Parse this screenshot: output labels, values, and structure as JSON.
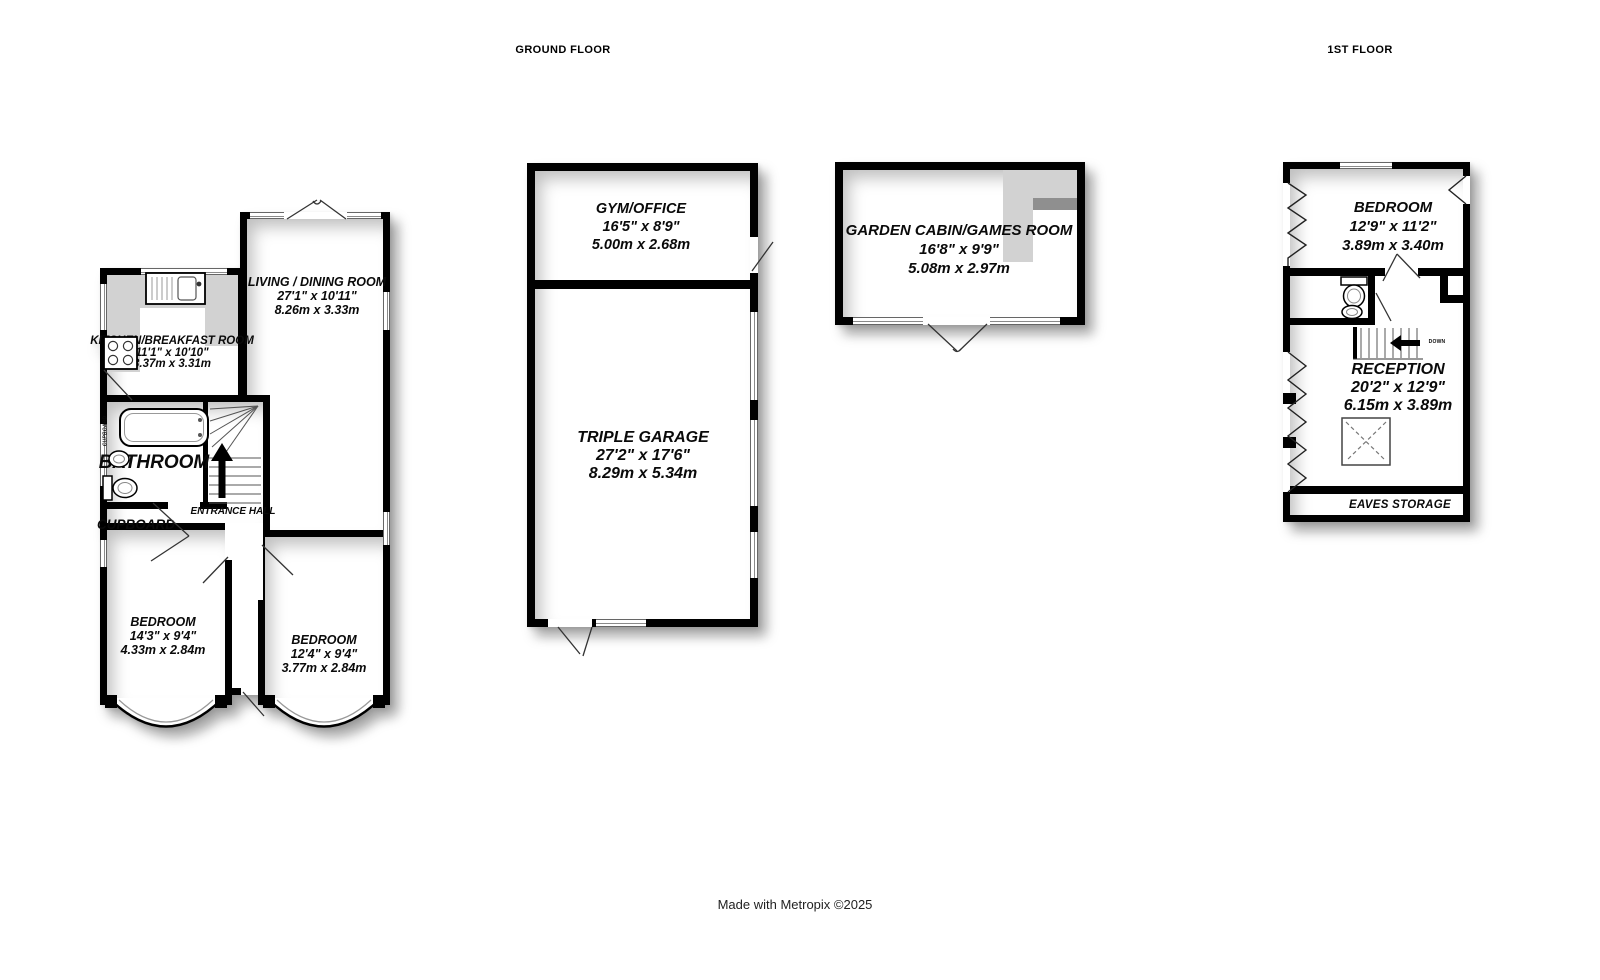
{
  "titles": {
    "ground_floor": "GROUND FLOOR",
    "first_floor": "1ST FLOOR"
  },
  "footer": {
    "credit": "Made with Metropix ©2025"
  },
  "colors": {
    "wall": "#000000",
    "room_fill": "#ffffff",
    "counter_gray": "#d2d2d2",
    "shadow": "rgba(0,0,0,0.33)"
  },
  "ground_floor": {
    "living_dining_room": {
      "name": "LIVING / DINING ROOM",
      "imperial": "27'1\" x 10'11\"",
      "metric": "8.26m x 3.33m"
    },
    "kitchen_breakfast_room": {
      "name": "KITCHEN/BREAKFAST ROOM",
      "imperial": "11'1\" x 10'10\"",
      "metric": "3.37m x 3.31m"
    },
    "bathroom": {
      "name": "BATHROOM"
    },
    "airing_cupboard": {
      "name": "CUPBOARD"
    },
    "cupboard": {
      "name": "CUPBOARD"
    },
    "entrance_hall": {
      "name": "ENTRANCE HALL"
    },
    "bedroom_front_left": {
      "name": "BEDROOM",
      "imperial": "14'3\" x 9'4\"",
      "metric": "4.33m x 2.84m"
    },
    "bedroom_front_right": {
      "name": "BEDROOM",
      "imperial": "12'4\" x 9'4\"",
      "metric": "3.77m x 2.84m"
    }
  },
  "outbuildings": {
    "gym_office": {
      "name": "GYM/OFFICE",
      "imperial": "16'5\" x 8'9\"",
      "metric": "5.00m x 2.68m"
    },
    "triple_garage": {
      "name": "TRIPLE GARAGE",
      "imperial": "27'2\" x 17'6\"",
      "metric": "8.29m x 5.34m"
    },
    "garden_cabin_games_room": {
      "name": "GARDEN CABIN/GAMES ROOM",
      "imperial": "16'8\" x 9'9\"",
      "metric": "5.08m x 2.97m"
    }
  },
  "first_floor": {
    "bedroom": {
      "name": "BEDROOM",
      "imperial": "12'9\" x 11'2\"",
      "metric": "3.89m x 3.40m"
    },
    "reception": {
      "name": "RECEPTION",
      "imperial": "20'2\" x 12'9\"",
      "metric": "6.15m x 3.89m"
    },
    "eaves_storage": {
      "name": "EAVES STORAGE"
    },
    "stairs": {
      "direction_label": "DOWN"
    }
  }
}
